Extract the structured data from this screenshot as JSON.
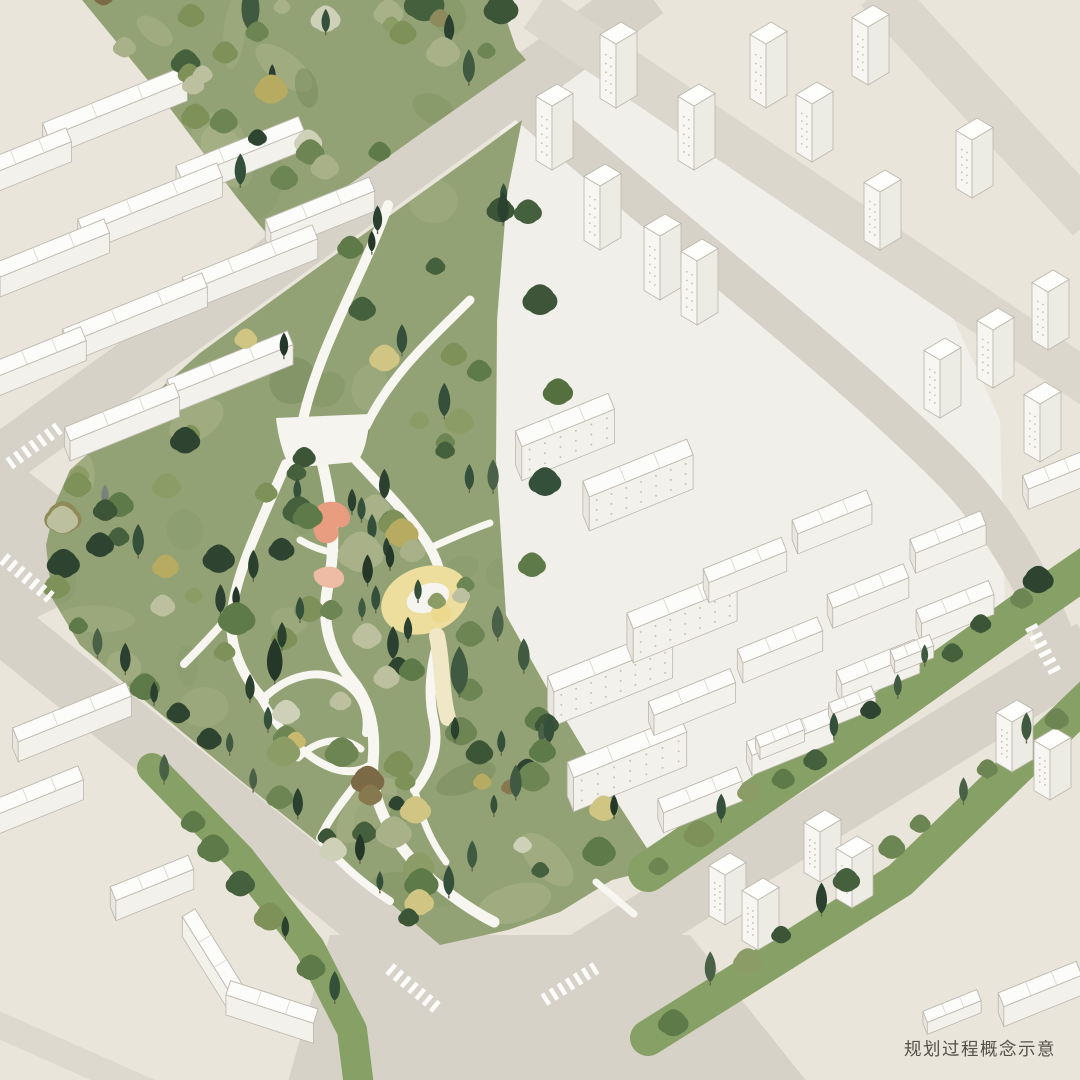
{
  "caption": {
    "text": "规划过程概念示意"
  },
  "palette": {
    "bg": "#e9e5da",
    "quarterGround": "#f1efe9",
    "road": "#d6d2c8",
    "roadLight": "#dbd7cc",
    "roadStub": "#ddd9cf",
    "parkGreen": "#93a275",
    "stripGreen": "#87a066",
    "pathWhite": "#f7f6f0",
    "plazaWhite": "#f5f4ee",
    "yellowArea": "#eede9d",
    "yellowDeep": "#ecd98e",
    "yellowTail": "#efe7c6",
    "pink1": "#e99d80",
    "pink2": "#eebba4",
    "mottle": [
      "#7c905d",
      "#a5b085",
      "#86996a",
      "#b3b990",
      "#6f8355"
    ],
    "bTop": "#fcfcfa",
    "bFront": "#f3f1ec",
    "bEnd": "#e9e6df",
    "bOutline": "#bdb8ad",
    "bWin": "#c7c2b6",
    "tLeft": "#f7f6f2",
    "tRight": "#ecebe4",
    "tTop": "#fefefc",
    "trunk": "#6b6450",
    "crosswalk": "#ffffff",
    "treePalettes": {
      "conifer": [
        "#2c4030",
        "#35503a",
        "#243728",
        "#3f5a41",
        "#4a6148"
      ],
      "dark": [
        "#44603c",
        "#3c5536",
        "#2f4430"
      ],
      "mid": [
        "#5f7a49",
        "#6d8553",
        "#7d9159",
        "#8b9c66"
      ],
      "sage": [
        "#a9b189",
        "#bcc09f",
        "#ced0b8"
      ],
      "yellow": [
        "#c8b96e",
        "#b7ab62",
        "#d1c583"
      ],
      "brown": [
        "#87794f",
        "#7b6a45",
        "#8d8a5e"
      ]
    }
  },
  "scene": {
    "quarter": [
      [
        497,
        108
      ],
      [
        570,
        42
      ],
      [
        640,
        60
      ],
      [
        820,
        185
      ],
      [
        945,
        300
      ],
      [
        1000,
        420
      ],
      [
        1005,
        608
      ],
      [
        880,
        720
      ],
      [
        730,
        797
      ],
      [
        647,
        847
      ],
      [
        612,
        880
      ],
      [
        588,
        760
      ],
      [
        547,
        690
      ],
      [
        506,
        615
      ],
      [
        496,
        460
      ],
      [
        498,
        300
      ],
      [
        508,
        190
      ]
    ],
    "roadJunctionWest": [
      [
        -5,
        446
      ],
      [
        72,
        506
      ],
      [
        72,
        600
      ],
      [
        -5,
        638
      ]
    ],
    "intersection": [
      [
        330,
        935
      ],
      [
        690,
        935
      ],
      [
        815,
        1092
      ],
      [
        285,
        1092
      ]
    ],
    "roads": [
      {
        "pts": [
          [
            -12,
            470
          ],
          [
            648,
            -8
          ]
        ],
        "w": 52,
        "c": "road"
      },
      {
        "pts": [
          [
            536,
            10
          ],
          [
            1092,
            386
          ]
        ],
        "w": 44,
        "c": "roadLight"
      },
      {
        "pts": [
          [
            878,
            -10
          ],
          [
            1090,
            220
          ]
        ],
        "w": 46,
        "c": "roadLight"
      },
      {
        "pts": [
          [
            -12,
            614
          ],
          [
            468,
            1002
          ]
        ],
        "w": 56,
        "c": "road"
      },
      {
        "pts": [
          [
            520,
            1000
          ],
          [
            1092,
            648
          ]
        ],
        "w": 58,
        "c": "road"
      },
      {
        "d": "M 512,92 C 660,220 840,360 948,468 C 1010,530 1052,612 1078,706",
        "w": 38,
        "c": "road"
      },
      {
        "pts": [
          [
            -8,
            1022
          ],
          [
            150,
            1092
          ]
        ],
        "w": 26,
        "c": "roadStub"
      }
    ],
    "parkBand": [
      [
        78,
        -5
      ],
      [
        498,
        -5
      ],
      [
        516,
        48
      ],
      [
        526,
        60
      ],
      [
        430,
        127
      ],
      [
        336,
        194
      ],
      [
        272,
        240
      ],
      [
        235,
        195
      ],
      [
        160,
        95
      ]
    ],
    "parkMain": [
      [
        70,
        470
      ],
      [
        200,
        353
      ],
      [
        350,
        244
      ],
      [
        480,
        151
      ],
      [
        522,
        120
      ],
      [
        507,
        195
      ],
      [
        497,
        320
      ],
      [
        496,
        460
      ],
      [
        506,
        615
      ],
      [
        548,
        690
      ],
      [
        590,
        760
      ],
      [
        635,
        830
      ],
      [
        660,
        868
      ],
      [
        612,
        880
      ],
      [
        560,
        912
      ],
      [
        508,
        930
      ],
      [
        440,
        945
      ],
      [
        340,
        860
      ],
      [
        240,
        780
      ],
      [
        150,
        705
      ],
      [
        80,
        645
      ],
      [
        52,
        598
      ],
      [
        46,
        545
      ],
      [
        56,
        502
      ]
    ],
    "greenStrips": [
      {
        "pts": [
          [
            648,
            872
          ],
          [
            900,
            700
          ],
          [
            1040,
            600
          ],
          [
            1095,
            562
          ]
        ],
        "w": 40
      },
      {
        "pts": [
          [
            648,
            1038
          ],
          [
            900,
            880
          ],
          [
            1095,
            692
          ]
        ],
        "w": 36
      },
      {
        "pts": [
          [
            152,
            768
          ],
          [
            240,
            858
          ],
          [
            310,
            948
          ],
          [
            352,
            1030
          ],
          [
            360,
            1095
          ]
        ],
        "w": 30
      }
    ],
    "mottles": [
      {
        "polyRef": "parkBand",
        "count": 9,
        "seed": 17
      },
      {
        "polyRef": "parkMain",
        "count": 24,
        "seed": 23
      }
    ],
    "plaza": "M 276,418 L 370,414 C 368,442 362,458 356,462 L 290,468 C 282,452 278,436 276,418 Z",
    "paths": [
      {
        "d": "M 388,205 C 362,278 318,348 302,424",
        "w": 10
      },
      {
        "d": "M 470,300 C 436,334 392,372 366,426",
        "w": 9
      },
      {
        "d": "M 286,464 C 258,528 236,574 232,612 C 228,642 240,674 264,700",
        "w": 10
      },
      {
        "d": "M 232,612 C 214,634 196,652 184,664",
        "w": 8
      },
      {
        "d": "M 322,462 C 334,512 336,548 328,586 C 320,626 332,656 352,680 C 370,702 376,730 373,762 C 370,800 392,844 432,880 C 454,898 474,912 494,922",
        "w": 11
      },
      {
        "d": "M 356,460 C 386,492 414,520 430,548 C 441,567 445,589 441,610",
        "w": 10
      },
      {
        "d": "M 438,642 C 430,670 428,696 434,722 C 439,747 431,770 415,790",
        "w": 10
      },
      {
        "d": "M 300,540 C 322,553 346,557 366,552",
        "w": 7
      },
      {
        "d": "M 262,700 C 288,674 320,667 345,683 C 362,694 369,712 366,733",
        "w": 8
      },
      {
        "d": "M 298,758 C 317,739 343,735 361,749",
        "w": 7
      },
      {
        "d": "M 262,700 C 276,726 293,744 313,758 C 332,771 354,777 372,764",
        "w": 8
      },
      {
        "d": "M 430,548 C 452,538 472,529 490,523",
        "w": 7
      },
      {
        "d": "M 373,762 C 352,790 332,812 320,838",
        "w": 8
      },
      {
        "d": "M 320,838 C 338,862 362,883 390,901",
        "w": 8
      },
      {
        "d": "M 415,790 C 420,815 430,840 446,862",
        "w": 7
      },
      {
        "d": "M 596,882 C 610,894 622,904 634,914",
        "w": 7
      }
    ],
    "yellow": {
      "cx": 425,
      "cy": 600,
      "rx": 45,
      "ry": 33,
      "rot": -20,
      "innerCx": 428,
      "innerCy": 598,
      "innerRx": 22,
      "innerRy": 14,
      "dotCx": 441,
      "dotCy": 613,
      "dotR": 10,
      "tail": "M 437,636 C 443,664 441,692 448,718"
    },
    "pinks": [
      {
        "d": "M 318,506 C 330,498 345,502 349,513 C 353,523 345,529 337,527 C 342,535 335,545 324,543 C 313,541 310,527 318,506 Z",
        "c": "pink1"
      },
      {
        "d": "M 314,572 C 324,564 338,565 343,574 C 347,582 340,589 330,588 C 320,587 312,581 314,572 Z",
        "c": "pink2"
      }
    ],
    "slabs": [
      {
        "x": 115,
        "y": 102,
        "len": 150
      },
      {
        "x": 26,
        "y": 152,
        "len": 92
      },
      {
        "x": 240,
        "y": 148,
        "len": 132
      },
      {
        "x": 150,
        "y": 198,
        "len": 150
      },
      {
        "x": 52,
        "y": 248,
        "len": 118
      },
      {
        "x": 320,
        "y": 205,
        "len": 112
      },
      {
        "x": 250,
        "y": 258,
        "len": 140
      },
      {
        "x": 135,
        "y": 308,
        "len": 150
      },
      {
        "x": 38,
        "y": 352,
        "len": 98
      },
      {
        "x": 230,
        "y": 362,
        "len": 130
      },
      {
        "x": 122,
        "y": 412,
        "len": 118
      },
      {
        "x": 72,
        "y": 712,
        "len": 122
      },
      {
        "x": 38,
        "y": 790,
        "len": 92
      },
      {
        "x": 152,
        "y": 878,
        "len": 84
      },
      {
        "x": 212,
        "y": 950,
        "len": 88,
        "ang": 58
      },
      {
        "x": 272,
        "y": 1002,
        "len": 92,
        "ang": 18
      },
      {
        "x": 565,
        "y": 420,
        "len": 100,
        "tall": true
      },
      {
        "x": 638,
        "y": 468,
        "len": 112,
        "tall": true
      },
      {
        "x": 610,
        "y": 660,
        "len": 128,
        "tall": true
      },
      {
        "x": 682,
        "y": 600,
        "len": 112,
        "tall": true
      },
      {
        "x": 627,
        "y": 747,
        "len": 122,
        "tall": true
      },
      {
        "x": 700,
        "y": 790,
        "len": 85
      },
      {
        "x": 790,
        "y": 732,
        "len": 88
      },
      {
        "x": 878,
        "y": 662,
        "len": 84
      },
      {
        "x": 955,
        "y": 602,
        "len": 78
      },
      {
        "x": 692,
        "y": 692,
        "len": 88
      },
      {
        "x": 780,
        "y": 640,
        "len": 86
      },
      {
        "x": 868,
        "y": 586,
        "len": 82
      },
      {
        "x": 948,
        "y": 532,
        "len": 76
      },
      {
        "x": 745,
        "y": 560,
        "len": 84
      },
      {
        "x": 832,
        "y": 512,
        "len": 80
      },
      {
        "x": 780,
        "y": 733,
        "len": 48
      },
      {
        "x": 852,
        "y": 700,
        "len": 46
      },
      {
        "x": 912,
        "y": 648,
        "len": 42
      },
      {
        "x": 1056,
        "y": 470,
        "len": 66
      },
      {
        "x": 952,
        "y": 1006,
        "len": 58
      },
      {
        "x": 1040,
        "y": 984,
        "len": 84
      }
    ],
    "towers": [
      {
        "x": 552,
        "y": 170
      },
      {
        "x": 616,
        "y": 108
      },
      {
        "x": 694,
        "y": 170
      },
      {
        "x": 766,
        "y": 108
      },
      {
        "x": 600,
        "y": 250
      },
      {
        "x": 660,
        "y": 300
      },
      {
        "x": 697,
        "y": 325
      },
      {
        "x": 868,
        "y": 85,
        "h": 58
      },
      {
        "x": 812,
        "y": 162,
        "h": 58
      },
      {
        "x": 880,
        "y": 250,
        "h": 58
      },
      {
        "x": 972,
        "y": 198,
        "h": 58
      },
      {
        "x": 993,
        "y": 388,
        "h": 58
      },
      {
        "x": 1048,
        "y": 350,
        "h": 58
      },
      {
        "x": 940,
        "y": 418,
        "h": 58
      },
      {
        "x": 1040,
        "y": 462,
        "h": 58
      },
      {
        "x": 725,
        "y": 925,
        "h": 50
      },
      {
        "x": 758,
        "y": 950,
        "h": 50
      },
      {
        "x": 820,
        "y": 882,
        "h": 50
      },
      {
        "x": 852,
        "y": 908,
        "h": 50
      },
      {
        "x": 1012,
        "y": 772,
        "h": 50
      },
      {
        "x": 1050,
        "y": 800,
        "h": 50
      }
    ],
    "treeRegions": [
      {
        "polyRef": "parkBand",
        "count": 34,
        "seed": 11,
        "mix": [
          [
            "conifer",
            0.22
          ],
          [
            "dark",
            0.16
          ],
          [
            "mid",
            0.34
          ],
          [
            "sage",
            0.14
          ],
          [
            "yellow",
            0.1
          ],
          [
            "brown",
            0.04
          ]
        ]
      },
      {
        "polyRef": "parkMain",
        "count": 120,
        "seed": 29,
        "mix": [
          [
            "conifer",
            0.3
          ],
          [
            "dark",
            0.18
          ],
          [
            "mid",
            0.32
          ],
          [
            "sage",
            0.1
          ],
          [
            "yellow",
            0.06
          ],
          [
            "brown",
            0.04
          ]
        ]
      }
    ],
    "treeRows": [
      {
        "a": [
          90,
          640
        ],
        "b": [
          420,
          920
        ],
        "n": 13,
        "j": 10,
        "seed": 5
      },
      {
        "a": [
          648,
          872
        ],
        "b": [
          1060,
          572
        ],
        "n": 14,
        "j": 8,
        "seed": 6
      },
      {
        "a": [
          660,
          1030
        ],
        "b": [
          1080,
          705
        ],
        "n": 12,
        "j": 8,
        "seed": 7
      },
      {
        "a": [
          155,
          772
        ],
        "b": [
          352,
          1020
        ],
        "n": 8,
        "j": 6,
        "seed": 8
      }
    ],
    "extraTrees": [
      [
        540,
        300,
        15,
        "round",
        "#3f5539"
      ],
      [
        558,
        392,
        13,
        "round",
        "#54703f"
      ],
      [
        528,
        212,
        12,
        "round",
        "#44603c"
      ],
      [
        545,
        482,
        14,
        "round",
        "#35503a"
      ],
      [
        532,
        565,
        12,
        "round",
        "#5f7a49"
      ],
      [
        63,
        518,
        16,
        "round",
        "#8f8a57"
      ],
      [
        100,
        545,
        12,
        "round",
        "#2f4430"
      ],
      [
        105,
        505,
        8,
        "conifer",
        "#78827c"
      ],
      [
        352,
        512,
        9,
        "conifer",
        "#2c4030"
      ],
      [
        372,
        540,
        10,
        "conifer",
        "#35503a"
      ],
      [
        390,
        568,
        9,
        "conifer",
        "#243728"
      ],
      [
        300,
        620,
        9,
        "conifer",
        "#35503a"
      ],
      [
        282,
        648,
        10,
        "conifer",
        "#2c4030"
      ],
      [
        362,
        618,
        8,
        "conifer",
        "#3f5a41"
      ],
      [
        408,
        640,
        9,
        "conifer",
        "#2c4030"
      ],
      [
        418,
        600,
        8,
        "conifer",
        "#35503a"
      ],
      [
        250,
        700,
        10,
        "conifer",
        "#2c4030"
      ],
      [
        268,
        730,
        9,
        "conifer",
        "#35503a"
      ],
      [
        470,
        690,
        11,
        "round",
        "#6d8553"
      ],
      [
        455,
        740,
        9,
        "conifer",
        "#2c4030"
      ]
    ],
    "crosswalks": [
      {
        "x": 34,
        "y": 446,
        "ang": -36,
        "n": 7
      },
      {
        "x": 27,
        "y": 578,
        "ang": 40,
        "n": 7
      },
      {
        "x": 413,
        "y": 988,
        "ang": 40,
        "n": 7
      },
      {
        "x": 570,
        "y": 984,
        "ang": -32,
        "n": 7
      },
      {
        "x": 1043,
        "y": 649,
        "ang": 62,
        "n": 6
      }
    ]
  }
}
